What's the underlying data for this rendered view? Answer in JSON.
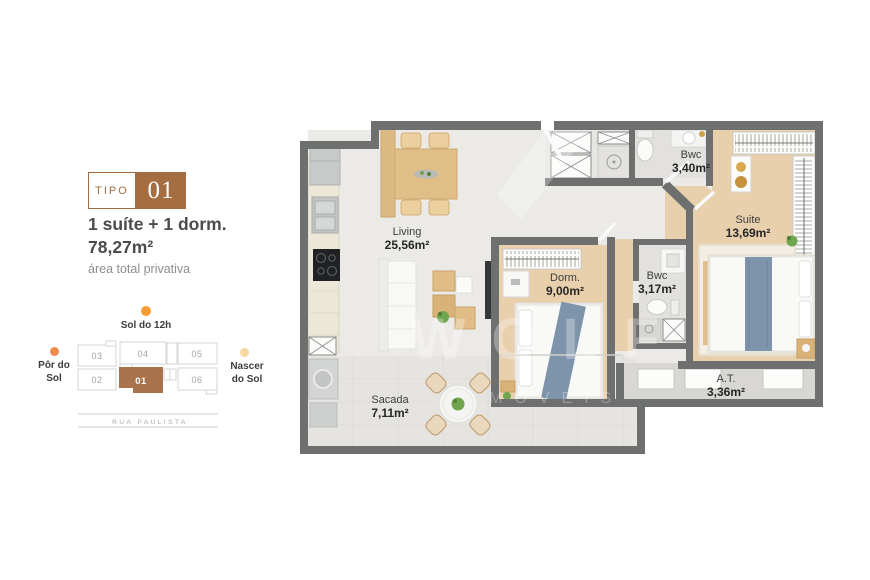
{
  "type_badge": {
    "label": "TIPO",
    "number": "01"
  },
  "summary": {
    "title_line1": "1 suíte + 1 dorm.",
    "title_line2": "78,27m²",
    "caption": "área total privativa"
  },
  "orientation_map": {
    "noon_label": "Sol do 12h",
    "west_line1": "Pôr do",
    "west_line2": "Sol",
    "east_line1": "Nascer",
    "east_line2": "do Sol",
    "street": "RUA PAULISTA",
    "units": [
      {
        "number": "03",
        "highlighted": false
      },
      {
        "number": "04",
        "highlighted": false
      },
      {
        "number": "05",
        "highlighted": false
      },
      {
        "number": "02",
        "highlighted": false
      },
      {
        "number": "01",
        "highlighted": true
      },
      {
        "number": "06",
        "highlighted": false
      }
    ],
    "dot_colors": {
      "noon": "#f59c31",
      "west": "#ee8a4e",
      "east": "#f6d7a0"
    }
  },
  "floor_plan": {
    "rooms": [
      {
        "name": "Living",
        "area": "25,56m²"
      },
      {
        "name": "Bwc",
        "area": "3,40m²"
      },
      {
        "name": "Suite",
        "area": "13,69m²"
      },
      {
        "name": "Dorm.",
        "area": "9,00m²"
      },
      {
        "name": "Bwc",
        "area": "3,17m²"
      },
      {
        "name": "Sacada",
        "area": "7,11m²"
      },
      {
        "name": "A.T.",
        "area": "3,36m²"
      }
    ],
    "watermark_line1": "WOLF",
    "watermark_line2": "IMÓVEIS",
    "colors": {
      "wall": "#6e706f",
      "wood_floor": "#e9d0ac",
      "tile_floor": "#ebeae7",
      "accent_brown": "#a46e42",
      "throw_blue": "#7e94ab"
    }
  }
}
